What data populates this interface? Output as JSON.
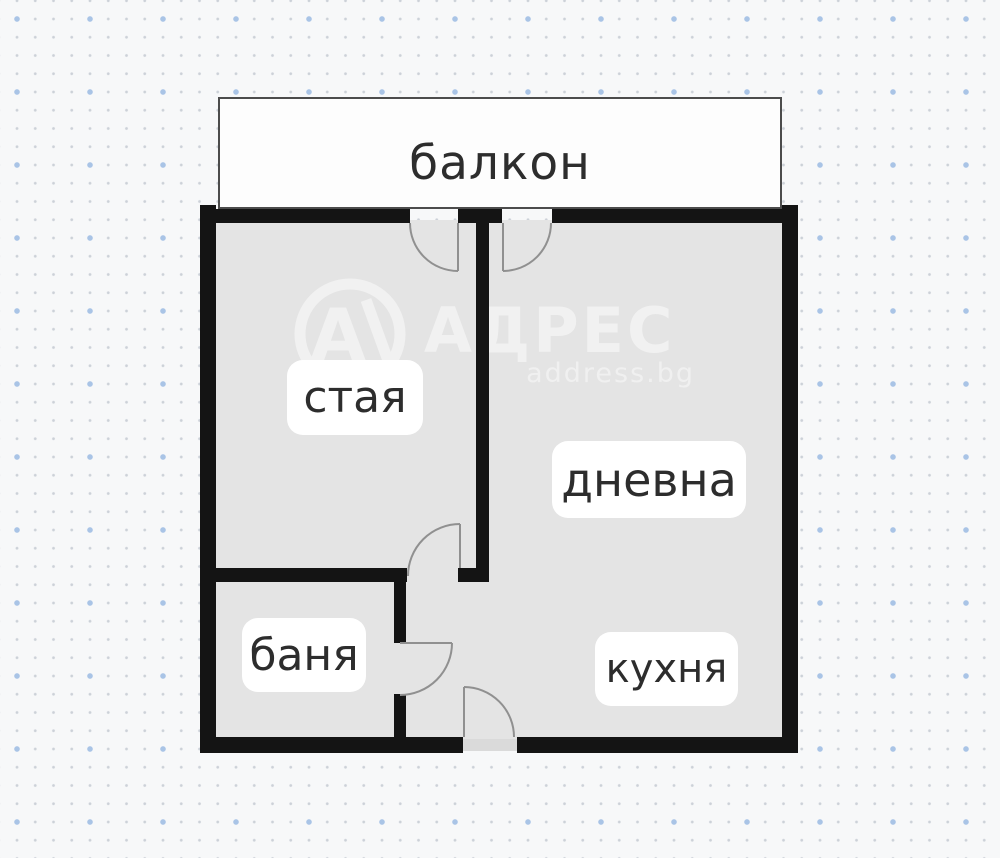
{
  "plan": {
    "rooms": {
      "balcony": {
        "label": "балкон"
      },
      "room": {
        "label": "стая"
      },
      "living": {
        "label": "дневна"
      },
      "bath": {
        "label": "баня"
      },
      "kitchen": {
        "label": "кухня"
      }
    }
  },
  "watermark": {
    "logo_letter": "A",
    "brand": "АДРЕС",
    "site": "address.bg"
  },
  "colors": {
    "wall": "#141414",
    "room_fill": "#e4e4e4",
    "balcony_fill": "#fdfdfd",
    "balcony_border": "#4c4c4c",
    "door_line": "#909090",
    "label_text": "#2d2d2d",
    "label_box": "#ffffff",
    "background": "#f7f8f9",
    "dot_small": "#ccd1d8",
    "dot_blue": "#a9c4e6",
    "watermark": "#ffffff"
  }
}
